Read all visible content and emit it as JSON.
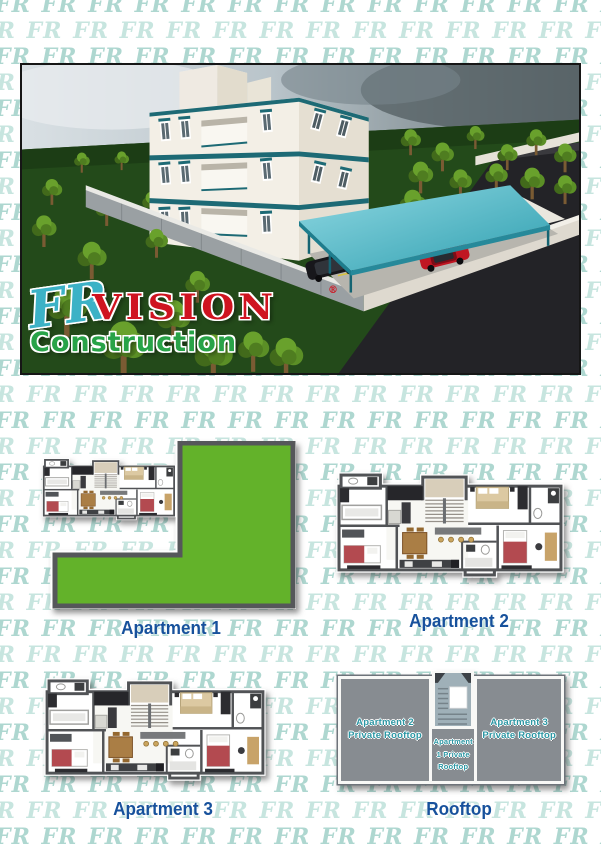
{
  "watermark": {
    "glyph": "FR"
  },
  "hero": {
    "logo": {
      "monogram": "FR",
      "name": "VISION",
      "reg": "®",
      "tagline": "Construction"
    }
  },
  "plans": {
    "apartment1": {
      "label": "Apartment 1"
    },
    "apartment2": {
      "label": "Apartment 2"
    },
    "apartment3": {
      "label": "Apartment 3"
    },
    "rooftop": {
      "label": "Rooftop"
    }
  },
  "rooftop_plan": {
    "left": {
      "l1": "Apartment 2",
      "l2": "Private Rooftop"
    },
    "center": {
      "l1": "Apartment",
      "l2": "1 Private",
      "l3": "Rooftop"
    },
    "right": {
      "l1": "Apartment 3",
      "l2": "Private Rooftop"
    }
  },
  "colors": {
    "watermark_teal": "#aed7d0",
    "label_blue": "#17519c",
    "rooftop_text_teal": "#2b96a3",
    "logo_red": "#cf1420",
    "logo_green": "#28a348",
    "logo_teal": "#3cb2c6",
    "building_accent_teal": "#1d6a75",
    "canopy_teal": "#3fa8ba",
    "lawn_green": "#63b22a"
  }
}
